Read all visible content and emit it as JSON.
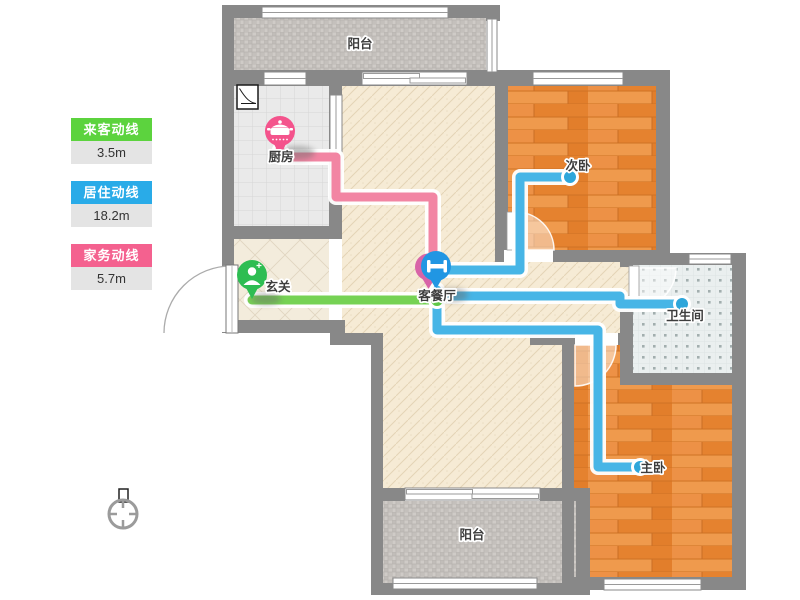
{
  "legend": {
    "items": [
      {
        "label": "来客动线",
        "value": "3.5m",
        "color": "#5CD33E"
      },
      {
        "label": "居住动线",
        "value": "18.2m",
        "color": "#29ABE8"
      },
      {
        "label": "家务动线",
        "value": "5.7m",
        "color": "#F4618F"
      }
    ]
  },
  "rooms": {
    "balcony_top": "阳台",
    "kitchen": "厨房",
    "entry": "玄关",
    "living": "客餐厅",
    "bedroom2": "次卧",
    "bathroom": "卫生间",
    "master": "主卧",
    "balcony_bottom": "阳台"
  },
  "markers": [
    {
      "name": "kitchen-marker",
      "icon": "pot-icon",
      "color": "#F4538C"
    },
    {
      "name": "entry-marker",
      "icon": "person-icon",
      "color": "#2EBD52"
    },
    {
      "name": "living-marker",
      "icon": "table-icon",
      "color": "#2196E3"
    }
  ],
  "colors": {
    "wall": "#888888",
    "guest_line": "#76D254",
    "living_line": "#47B5E6",
    "chore_line": "#F285A3"
  }
}
